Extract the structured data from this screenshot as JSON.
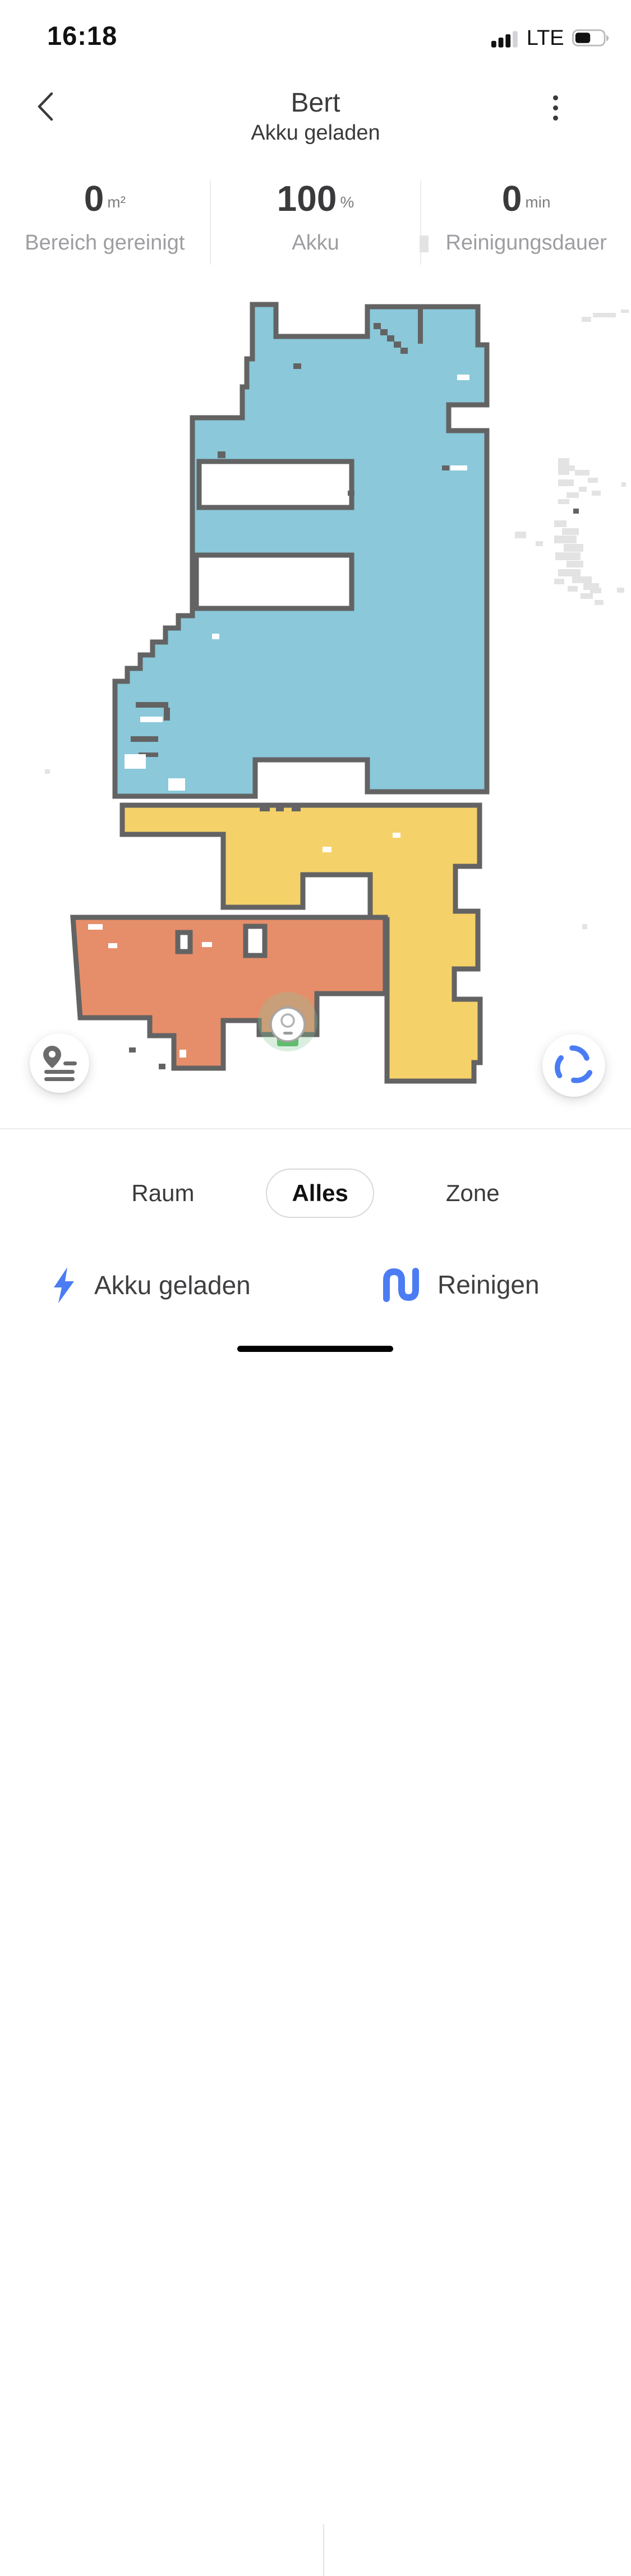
{
  "status_bar": {
    "time": "16:18",
    "network": "LTE"
  },
  "header": {
    "title": "Bert",
    "subtitle": "Akku geladen"
  },
  "stats": [
    {
      "value": "0",
      "unit": "m²",
      "label": "Bereich gereinigt"
    },
    {
      "value": "100",
      "unit": "%",
      "label": "Akku"
    },
    {
      "value": "0",
      "unit": "min",
      "label": "Reinigungsdauer"
    }
  ],
  "map": {
    "colors": {
      "room_blue": "#8AC8DA",
      "room_yellow": "#F5D169",
      "room_orange": "#E68E6A",
      "wall": "#636363",
      "debris": "#E3E3E3",
      "dock_green": "#5FBE6E",
      "halo": "rgba(134,198,151,0.30)"
    },
    "robot_status": "docked"
  },
  "tabs": [
    {
      "label": "Raum",
      "selected": false
    },
    {
      "label": "Alles",
      "selected": true
    },
    {
      "label": "Zone",
      "selected": false
    }
  ],
  "actions": {
    "status": {
      "label": "Akku geladen"
    },
    "clean": {
      "label": "Reinigen"
    }
  },
  "accent": "#4B7CF3"
}
